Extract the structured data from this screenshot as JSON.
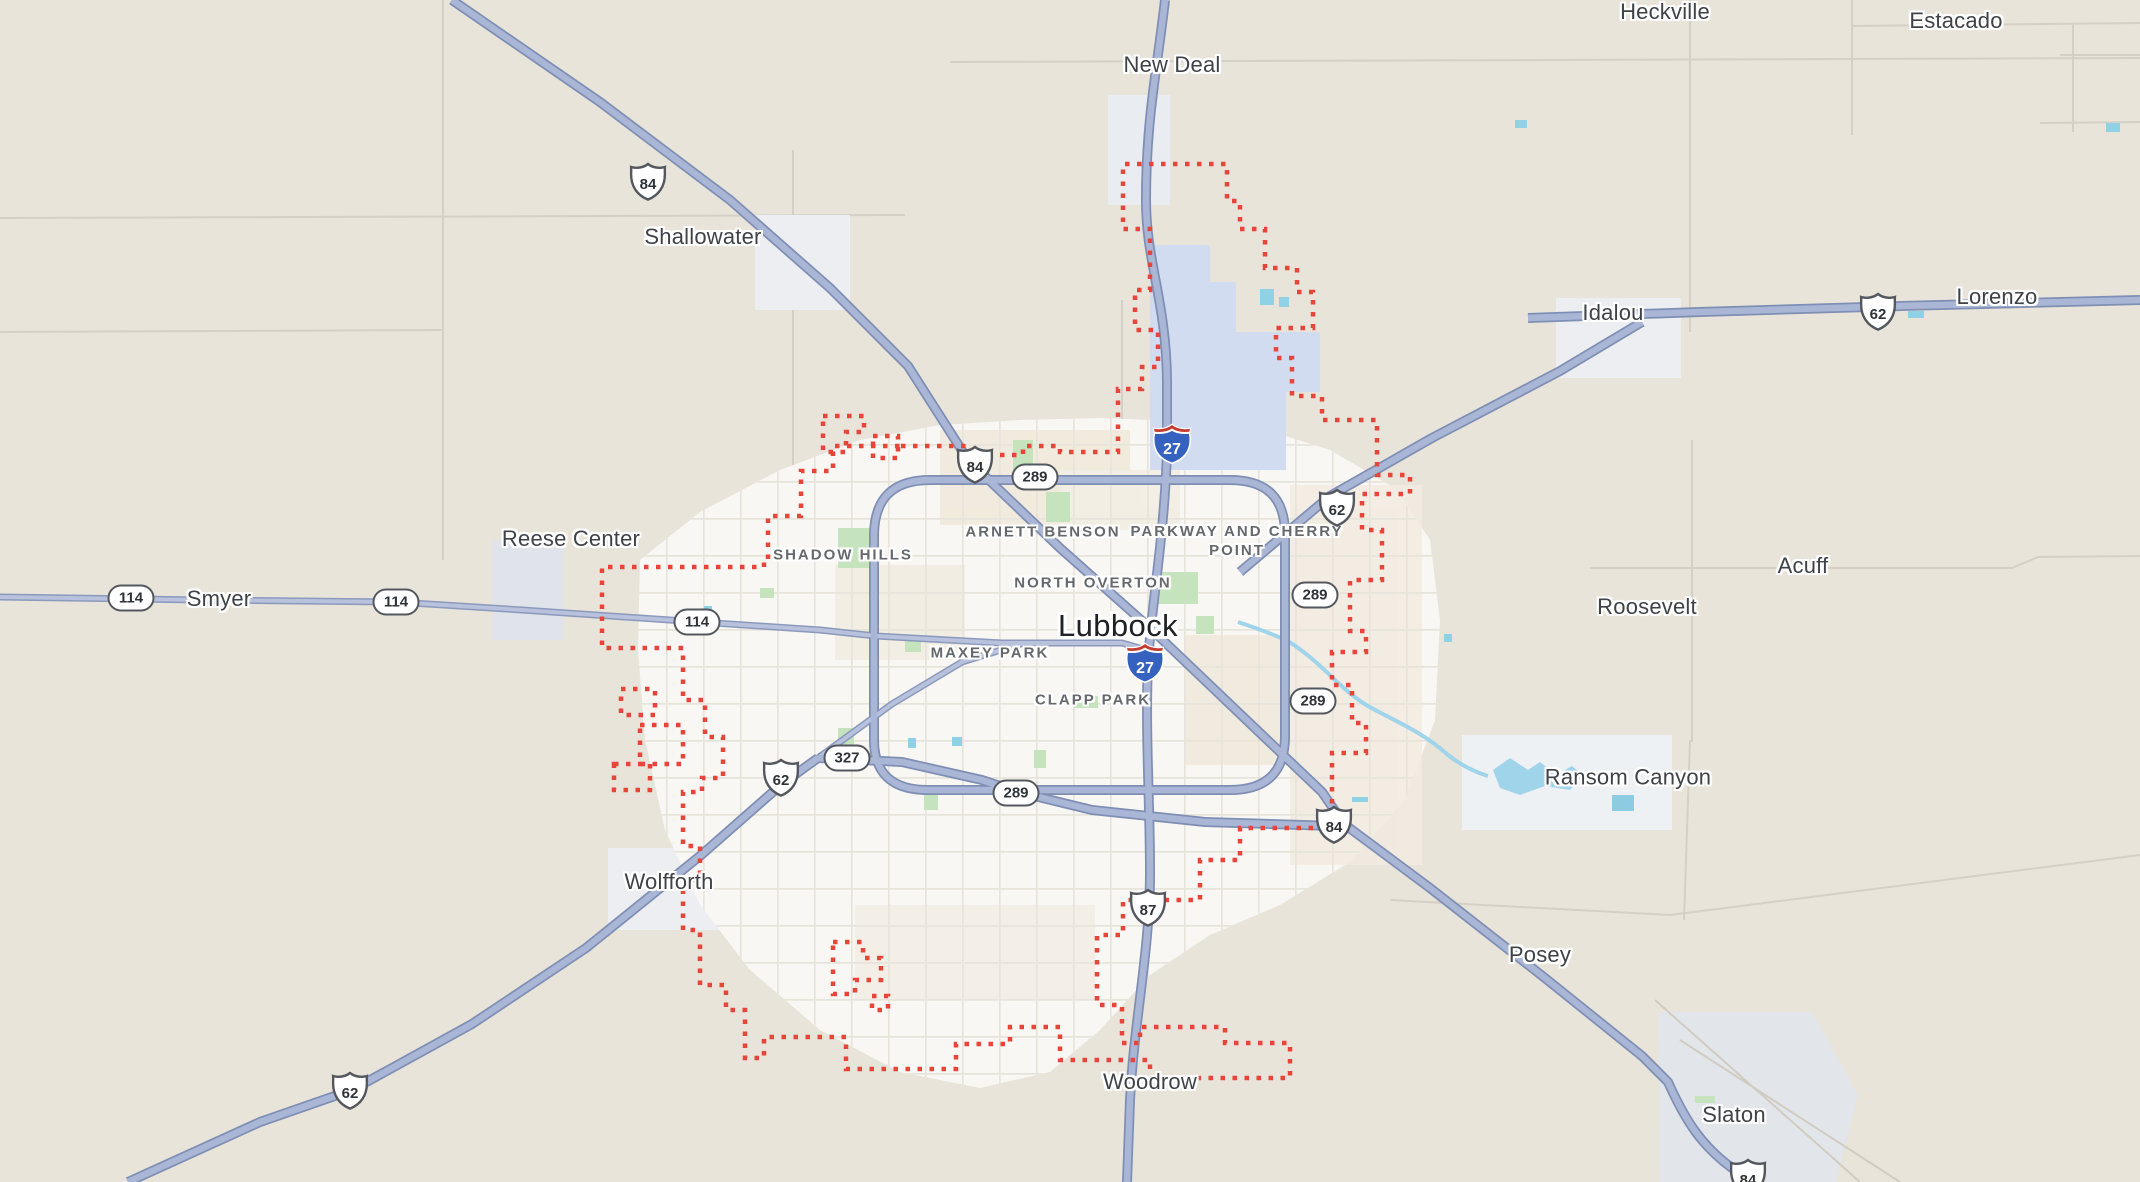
{
  "map_title": "Lubbock city map",
  "city": {
    "name": "Lubbock",
    "x": 1118,
    "y": 626
  },
  "towns": [
    {
      "name": "New Deal",
      "x": 1172,
      "y": 65
    },
    {
      "name": "Shallowater",
      "x": 703,
      "y": 237
    },
    {
      "name": "Heckville",
      "x": 1665,
      "y": 12
    },
    {
      "name": "Estacado",
      "x": 1956,
      "y": 21
    },
    {
      "name": "Lorenzo",
      "x": 1997,
      "y": 297
    },
    {
      "name": "Idalou",
      "x": 1613,
      "y": 313
    },
    {
      "name": "Smyer",
      "x": 219,
      "y": 599
    },
    {
      "name": "Reese Center",
      "x": 571,
      "y": 539
    },
    {
      "name": "Acuff",
      "x": 1803,
      "y": 566
    },
    {
      "name": "Roosevelt",
      "x": 1647,
      "y": 607
    },
    {
      "name": "Ransom Canyon",
      "x": 1628,
      "y": 777
    },
    {
      "name": "Posey",
      "x": 1540,
      "y": 955
    },
    {
      "name": "Wolfforth",
      "x": 669,
      "y": 882
    },
    {
      "name": "Woodrow",
      "x": 1150,
      "y": 1082
    },
    {
      "name": "Slaton",
      "x": 1734,
      "y": 1115
    }
  ],
  "neighborhoods": [
    {
      "name": "SHADOW HILLS",
      "x": 843,
      "y": 555
    },
    {
      "name": "ARNETT BENSON",
      "x": 1043,
      "y": 532
    },
    {
      "name": "PARKWAY AND CHERRY POINT",
      "x": 1237,
      "y": 541
    },
    {
      "name": "NORTH OVERTON",
      "x": 1093,
      "y": 583
    },
    {
      "name": "MAXEY PARK",
      "x": 990,
      "y": 653
    },
    {
      "name": "CLAPP PARK",
      "x": 1093,
      "y": 700
    }
  ],
  "shields": {
    "us": [
      {
        "num": "84",
        "x": 648,
        "y": 182
      },
      {
        "num": "84",
        "x": 975,
        "y": 465
      },
      {
        "num": "62",
        "x": 1337,
        "y": 508
      },
      {
        "num": "62",
        "x": 1878,
        "y": 312
      },
      {
        "num": "62",
        "x": 781,
        "y": 778
      },
      {
        "num": "84",
        "x": 1334,
        "y": 825
      },
      {
        "num": "87",
        "x": 1148,
        "y": 908
      },
      {
        "num": "62",
        "x": 350,
        "y": 1091
      },
      {
        "num": "84",
        "x": 1748,
        "y": 1178
      }
    ],
    "loop": [
      {
        "num": "289",
        "x": 1035,
        "y": 477
      },
      {
        "num": "289",
        "x": 1315,
        "y": 595
      },
      {
        "num": "289",
        "x": 1313,
        "y": 701
      },
      {
        "num": "289",
        "x": 1016,
        "y": 793
      },
      {
        "num": "114",
        "x": 131,
        "y": 598
      },
      {
        "num": "114",
        "x": 396,
        "y": 602
      },
      {
        "num": "114",
        "x": 697,
        "y": 622
      },
      {
        "num": "327",
        "x": 847,
        "y": 758
      }
    ],
    "interstate": [
      {
        "num": "27",
        "x": 1172,
        "y": 444
      },
      {
        "num": "27",
        "x": 1145,
        "y": 663
      }
    ]
  },
  "colors": {
    "background": "#e8e4da",
    "urban_fill": "#f8f7f3",
    "boundary_red": "#e8453a",
    "highway_fill": "#aab6d6",
    "highway_casing": "#7f8fb4",
    "secondary_fill": "#b9c2dc",
    "water": "#8fd2e6",
    "water_area": "#d2dcf0",
    "park_green": "#c5e3bd",
    "interstate_blue": "#3561bf",
    "interstate_red": "#c63b2f"
  }
}
